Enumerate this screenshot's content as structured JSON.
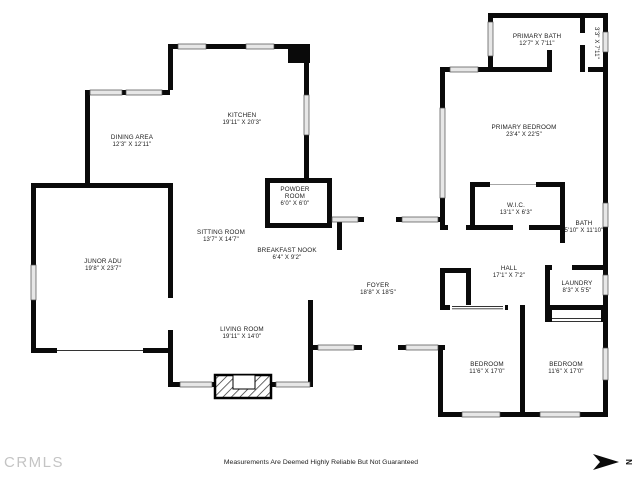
{
  "plan": {
    "rooms": {
      "dining": {
        "name": "DINING AREA",
        "dims": "12'3\" X 12'11\""
      },
      "kitchen": {
        "name": "KITCHEN",
        "dims": "19'11\" X 20'3\""
      },
      "powder": {
        "line1": "POWDER",
        "line2": "ROOM",
        "dims": "6'0\" X 6'0\""
      },
      "sitting": {
        "name": "SITTING ROOM",
        "dims": "13'7\" X 14'7\""
      },
      "nook": {
        "name": "BREAKFAST NOOK",
        "dims": "6'4\" X 9'2\""
      },
      "adu": {
        "name": "JUNOR ADU",
        "dims": "19'8\" X 23'7\""
      },
      "foyer": {
        "name": "FOYER",
        "dims": "18'8\" X 18'5\""
      },
      "living": {
        "name": "LIVING ROOM",
        "dims": "19'11\" X 14'0\""
      },
      "primary_bath": {
        "name": "PRIMARY BATH",
        "dims": "12'7\" X 7'11\""
      },
      "closet_small": {
        "dims": "3'3\" X 7'11\""
      },
      "primary_bedroom": {
        "name": "PRIMARY BEDROOM",
        "dims": "23'4\" X 22'5\""
      },
      "wic": {
        "name": "W.I.C.",
        "dims": "13'1\" X 6'3\""
      },
      "bath": {
        "name": "BATH",
        "dims": "5'10\" X 11'10\""
      },
      "hall": {
        "name": "HALL",
        "dims": "17'1\" X 7'2\""
      },
      "laundry": {
        "name": "LAUNDRY",
        "dims": "8'3\" X 5'5\""
      },
      "bedroom_left": {
        "name": "BEDROOM",
        "dims": "11'6\" X 17'0\""
      },
      "bedroom_right": {
        "name": "BEDROOM",
        "dims": "11'6\" X 17'0\""
      }
    },
    "footer": {
      "disclaimer": "Measurements Are Deemed Highly Reliable But Not Guaranteed",
      "brand": "CRMLS",
      "north_label": "N"
    }
  }
}
